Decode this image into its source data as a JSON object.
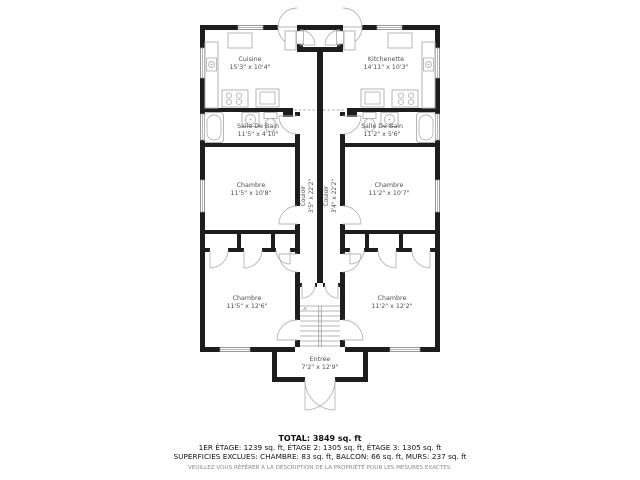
{
  "colors": {
    "wall": "#1d1d1d",
    "fixture": "#b5b5b5",
    "label": "#4f4f4f",
    "text": "#111111",
    "disclaimer": "#8a8a8a",
    "background": "#ffffff"
  },
  "rooms": {
    "cuisine": {
      "name": "Cuisine",
      "dims": "15'3\" x 10'4\""
    },
    "kitchenette": {
      "name": "Kitchenette",
      "dims": "14'11\" x 10'3\""
    },
    "salle_de_bain_left": {
      "name": "Salle De Bain",
      "dims": "11'5\" x 4'10\""
    },
    "salle_de_bain_right": {
      "name": "Salle De Bain",
      "dims": "11'2\" x 5'6\""
    },
    "chambre_mid_left": {
      "name": "Chambre",
      "dims": "11'5\" x 10'8\""
    },
    "chambre_mid_right": {
      "name": "Chambre",
      "dims": "11'2\" x 10'7\""
    },
    "couloir_left": {
      "name": "Couloir",
      "dims": "3'5\" x 22'2\""
    },
    "couloir_right": {
      "name": "Couloir",
      "dims": "3'4\" x 22'2\""
    },
    "chambre_bottom_left": {
      "name": "Chambre",
      "dims": "11'5\" x 12'6\""
    },
    "chambre_bottom_right": {
      "name": "Chambre",
      "dims": "11'2\" x 12'2\""
    },
    "entree": {
      "name": "Entrée",
      "dims": "7'2\" x 12'9\""
    }
  },
  "summary": {
    "total": "TOTAL: 3849 sq. ft",
    "floors": "1ER ÉTAGE: 1239 sq. ft, ÉTAGE 2: 1305 sq. ft, ÉTAGE 3: 1305 sq. ft",
    "exclusions": "SUPERFICIES EXCLUES: CHAMBRE: 83 sq. ft, BALCON: 66 sq. ft, MURS: 237 sq. ft",
    "disclaimer": "VEUILLEZ VOUS RÉFÉRER À LA DESCRIPTION DE LA PROPRIÉTÉ POUR LES MESURES EXACTES."
  }
}
